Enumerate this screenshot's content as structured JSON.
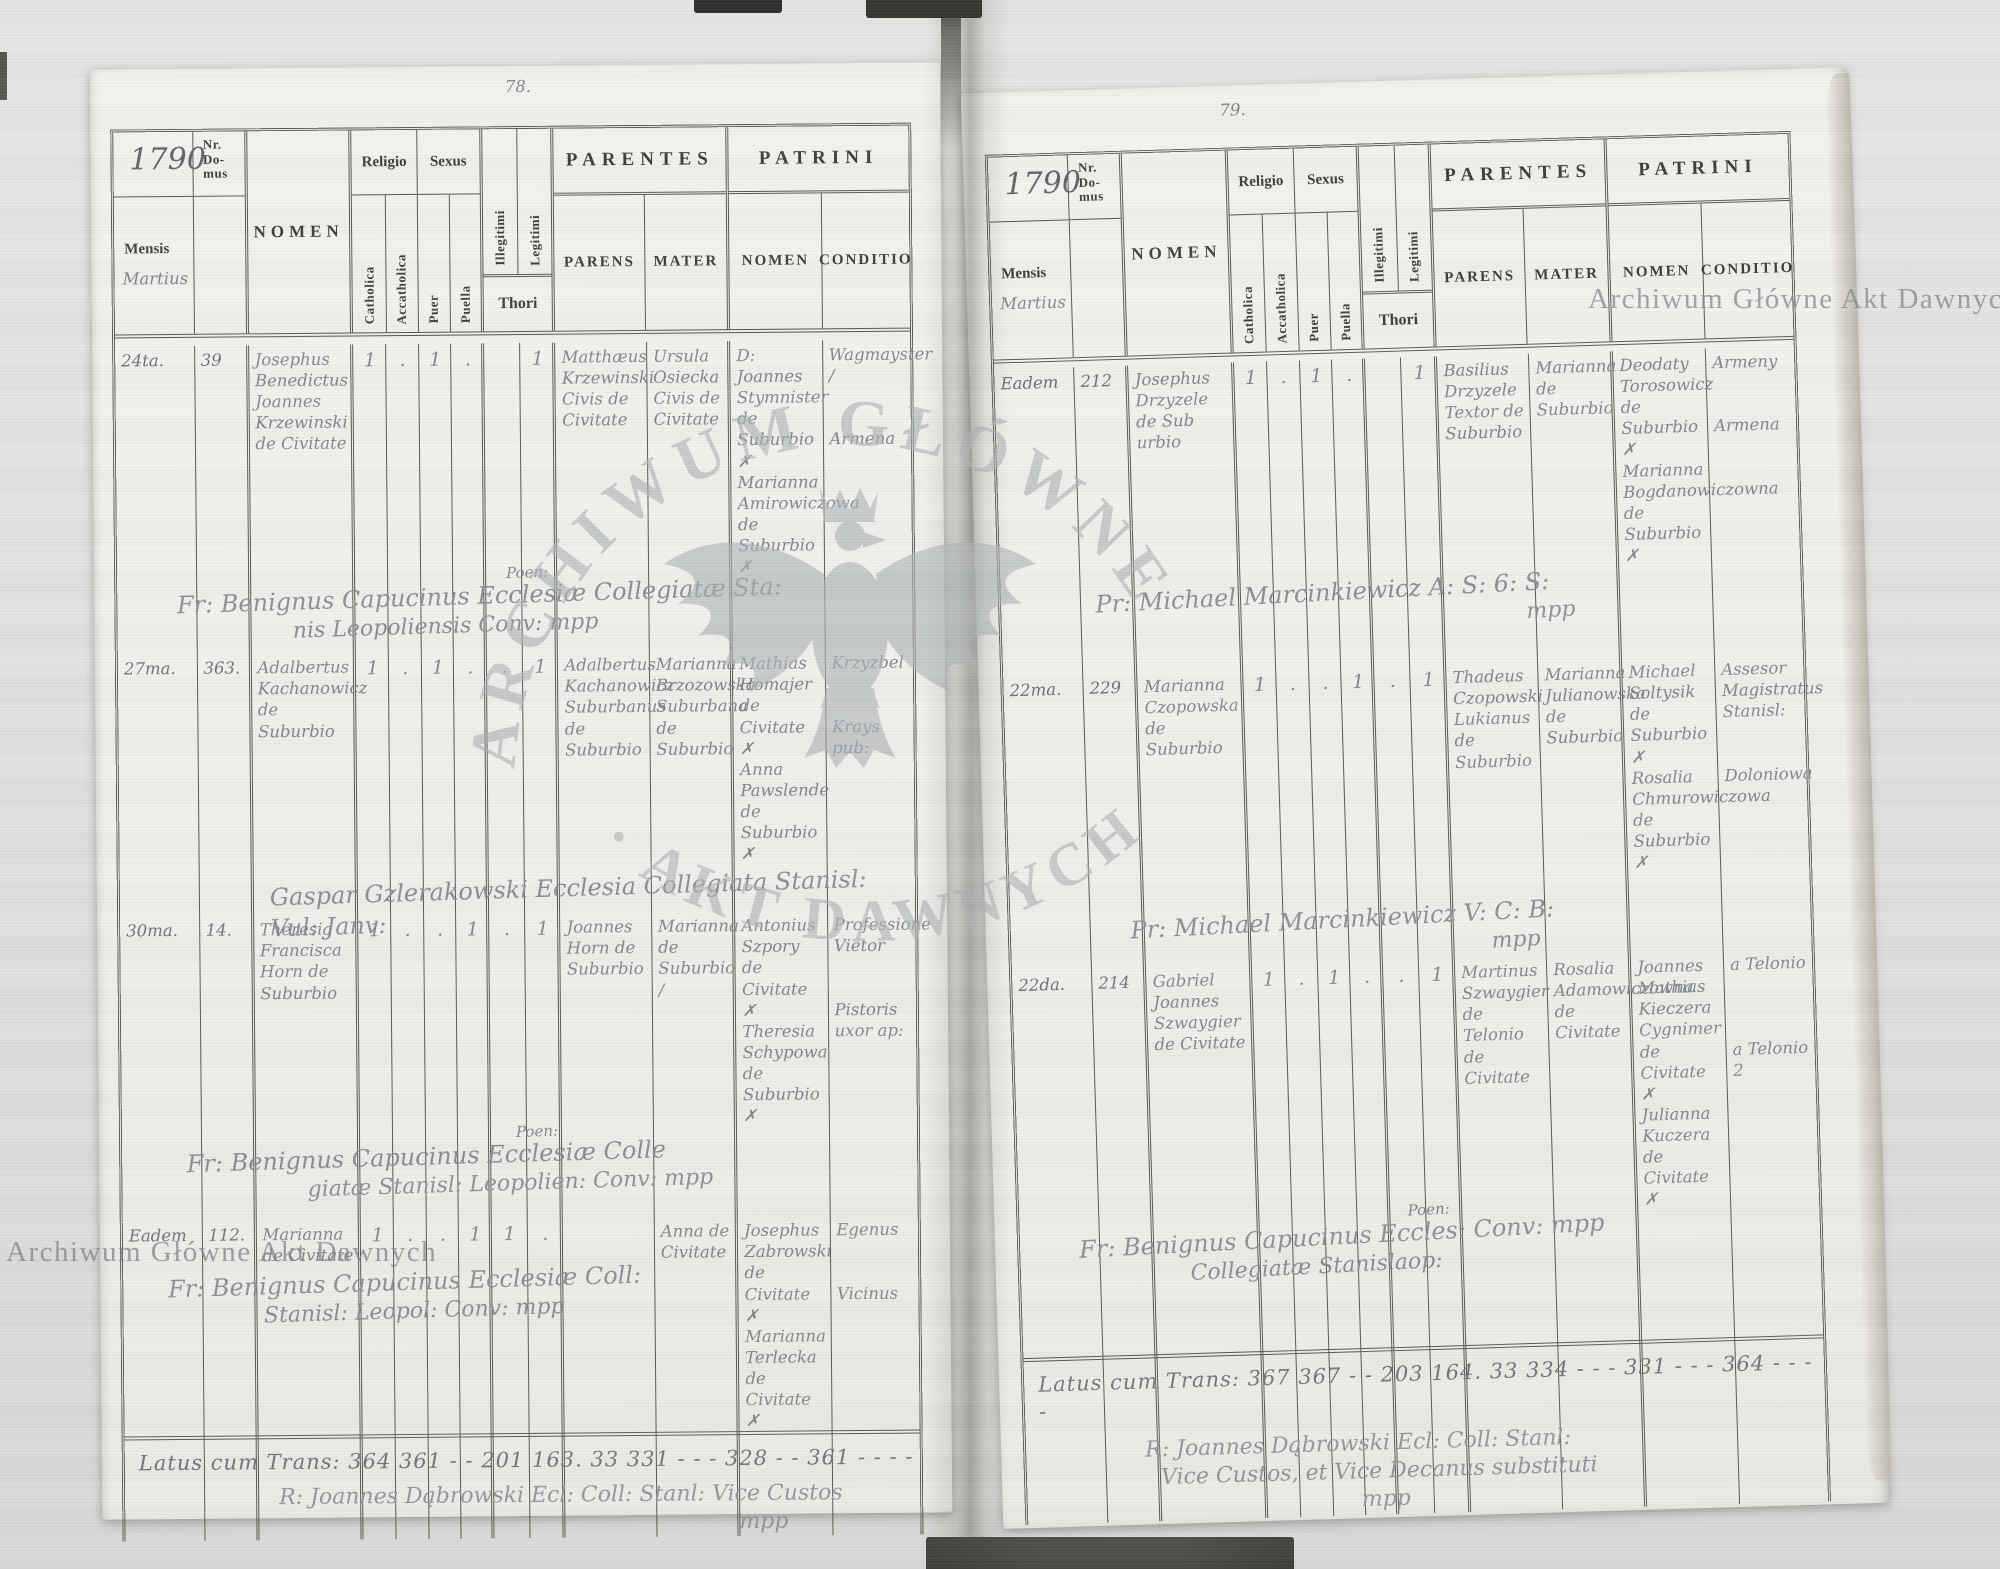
{
  "watermark": {
    "line": "Archiwum Główne Akt Dawnych",
    "arc_top": "ARCHIWUM GŁÓWNE",
    "arc_bottom": "· AKT DAWNYCH"
  },
  "header": {
    "year": "1790",
    "nr_domus": "Nr.\nDo-\nmus",
    "mensis": "Mensis",
    "month": "Martius",
    "nomen": "NOMEN",
    "religio": "Religio",
    "sexus": "Sexus",
    "catholica": "Catholica",
    "accatholica": "Accatholica",
    "puer": "Puer",
    "puella": "Puella",
    "illegitimi": "Illegitimi",
    "legitimi": "Legitimi",
    "thori": "Thori",
    "parentes": "PARENTES",
    "parens": "PARENS",
    "mater": "MATER",
    "patrini": "PATRINI",
    "patrini_nomen": "NOMEN",
    "conditio": "CONDITIO"
  },
  "left_page": {
    "page_number": "78.",
    "entries": [
      {
        "date": "24ta.",
        "nr": "39",
        "nomen": "Josephus Benedictus Joannes Krzewinski de Civitate",
        "catholica": "1",
        "accatholica": ".",
        "puer": "1",
        "puella": ".",
        "illegitimi": "",
        "legitimi": "1",
        "parens": "Matthæus Krzewinski Civis de Civitate",
        "mater": "Ursula Osiecka Civis de Civitate",
        "patrini_nomen": "D: Joannes Stymnister de Suburbio\n✗\nMarianna Amirowiczowa de Suburbio\n✗",
        "conditio": "Wagmayster /\n\n\nArmena"
      },
      {
        "date": "27ma.",
        "nr": "363.",
        "nomen": "Adalbertus Kachanowicz de Suburbio",
        "catholica": "1",
        "accatholica": ".",
        "puer": "1",
        "puella": ".",
        "illegitimi": ".",
        "legitimi": "1",
        "parens": "Adalbertus Kachanowicz Suburbanus de Suburbio",
        "mater": "Marianna Brzozowska Suburbana de Suburbio",
        "patrini_nomen": "Mathias Homajer de Civitate\n✗\nAnna Pawslende de Suburbio\n✗",
        "conditio": "Krzyzbel\n\n\nKrays pub:"
      },
      {
        "date": "30ma.",
        "nr": "14.",
        "nomen": "Theresia Francisca Horn de Suburbio",
        "catholica": "1",
        "accatholica": ".",
        "puer": ".",
        "puella": "1",
        "illegitimi": ".",
        "legitimi": "1",
        "parens": "Joannes Horn de Suburbio",
        "mater": "Marianna de Suburbio /",
        "patrini_nomen": "Antonius Szpory de Civitate\n✗\nTheresia Schypowa de Suburbio\n✗",
        "conditio": "Professione Vietor\n\n\nPistoris uxor ap:"
      },
      {
        "date": "Eadem",
        "nr": "112.",
        "nomen": "Marianna de Civitate",
        "catholica": "1",
        "accatholica": ".",
        "puer": ".",
        "puella": "1",
        "illegitimi": "1",
        "legitimi": ".",
        "parens": "",
        "mater": "Anna de Civitate",
        "patrini_nomen": "Josephus Zabrowski de Civitate\n✗\nMarianna Terlecka de Civitate\n✗",
        "conditio": "Egenus\n\n\nVicinus"
      }
    ],
    "signatures": [
      {
        "note": "Poen:",
        "line1": "Fr: Benignus Capucinus Ecclesiæ Collegiatæ Sta:",
        "line2": "nis Leopoliensis      Conv: mpp"
      },
      {
        "note": "",
        "line1": "Gaspar Gzlerakowski Ecclesia Collegiata Stanisl: Vul: Janv:",
        "line2": ""
      },
      {
        "note": "Poen:",
        "line1": "Fr: Benignus Capucinus Ecclesiæ Colle",
        "line2": "giatæ Stanisl: Leopolien:    Conv: mpp"
      },
      {
        "note": "",
        "line1": "Fr: Benignus Capucinus Ecclesiæ Coll:",
        "line2": "Stanisl: Leopol:    Conv: mpp"
      }
    ],
    "latus": "Latus cum Trans: 364 361 - - 201 163. 33 331 - - - 328 - - 361 - - - -",
    "clerk": {
      "line1": "R: Joannes Dąbrowski Ecl: Coll: Stanl: Vice Custos",
      "line2": "mpp"
    }
  },
  "right_page": {
    "page_number": "79.",
    "entries": [
      {
        "date": "Eadem",
        "nr": "212",
        "nomen": "Josephus Drzyzele de Sub urbio",
        "catholica": "1",
        "accatholica": ".",
        "puer": "1",
        "puella": ".",
        "illegitimi": "",
        "legitimi": "1",
        "parens": "Basilius Drzyzele Textor de Suburbio",
        "mater": "Marianna de Suburbio",
        "patrini_nomen": "Deodaty Torosowicz de Suburbio\n✗\nMarianna Bogdanowiczowna de Suburbio\n✗",
        "conditio": "Armeny\n\n\nArmena"
      },
      {
        "date": "22ma.",
        "nr": "229",
        "nomen": "Marianna Czopowska de Suburbio",
        "catholica": "1",
        "accatholica": ".",
        "puer": ".",
        "puella": "1",
        "illegitimi": ".",
        "legitimi": "1",
        "parens": "Thadeus Czopowski Lukianus de Suburbio",
        "mater": "Marianna Julianowska de Suburbio",
        "patrini_nomen": "Michael Soltysik de Suburbio\n✗\nRosalia Chmurowiczowa de Suburbio\n✗",
        "conditio": "Assesor Magistratus Stanisl:\n\n\nDoloniowa"
      },
      {
        "date": "22da.",
        "nr": "214",
        "nomen": "Gabriel Joannes Szwaygier de Civitate",
        "catholica": "1",
        "accatholica": ".",
        "puer": "1",
        "puella": ".",
        "illegitimi": ".",
        "legitimi": "1",
        "parens": "Martinus Szwaygier de Telonio de Civitate",
        "mater": "Rosalia Adamowiczowna de Civitate",
        "patrini_nomen": "Joannes Mathias Kieczera Cygnimer de Civitate\n✗\nJulianna Kuczera de Civitate\n✗",
        "conditio": "a Telonio\n\n\n\na Telonio 2"
      }
    ],
    "signatures": [
      {
        "note": "",
        "line1": "Pr: Michael Marcinkiewicz A: S: 6: S:",
        "line2": "mpp"
      },
      {
        "note": "",
        "line1": "Pr: Michael Marcinkiewicz V: C: B:",
        "line2": "mpp"
      },
      {
        "note": "Poen:",
        "line1": "Fr: Benignus Capucinus    Eccles: Conv: mpp",
        "line2": "Collegiatæ Stanislaop:"
      }
    ],
    "latus": "Latus cum Trans: 367 367 - - 203 164. 33 334 - - - 331 - - - 364 - - - -",
    "clerk": {
      "line1": "R: Joannes Dąbrowski Ecl: Coll: Stanl:",
      "line2": "Vice Custos, et Vice Decanus substituti",
      "line3": "mpp"
    }
  }
}
